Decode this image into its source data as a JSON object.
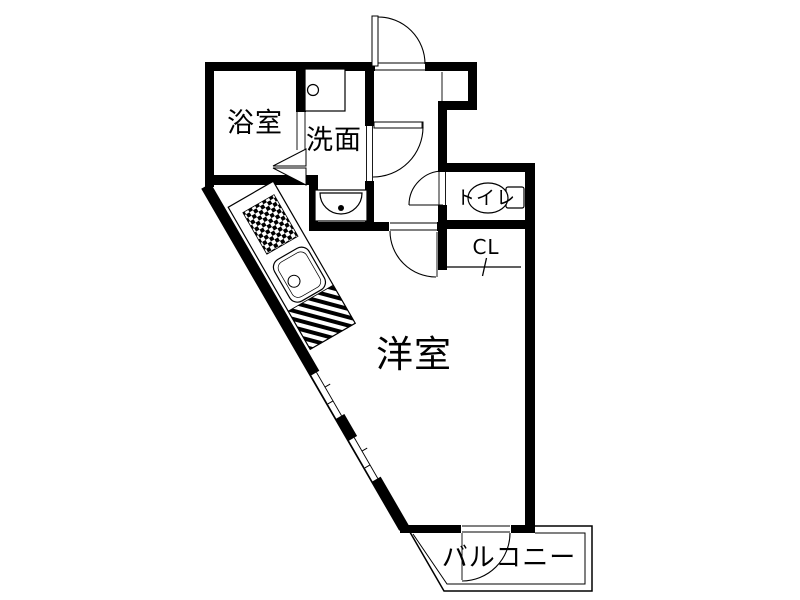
{
  "title": "apartment-floor-plan",
  "colors": {
    "background": "#ffffff",
    "wall": "#000000",
    "line": "#000000",
    "text": "#000000"
  },
  "rooms": [
    {
      "id": "bathroom",
      "label": "浴室"
    },
    {
      "id": "washroom",
      "label": "洗面"
    },
    {
      "id": "toilet",
      "label": "トイレ"
    },
    {
      "id": "closet",
      "label": "CL"
    },
    {
      "id": "western-room",
      "label": "洋室"
    },
    {
      "id": "balcony",
      "label": "バルコニー"
    }
  ],
  "fixtures": [
    {
      "id": "kitchen-counter"
    },
    {
      "id": "stove-burners"
    },
    {
      "id": "kitchen-sink"
    },
    {
      "id": "washbasin"
    },
    {
      "id": "washing-machine-pan"
    },
    {
      "id": "toilet-bowl"
    }
  ]
}
